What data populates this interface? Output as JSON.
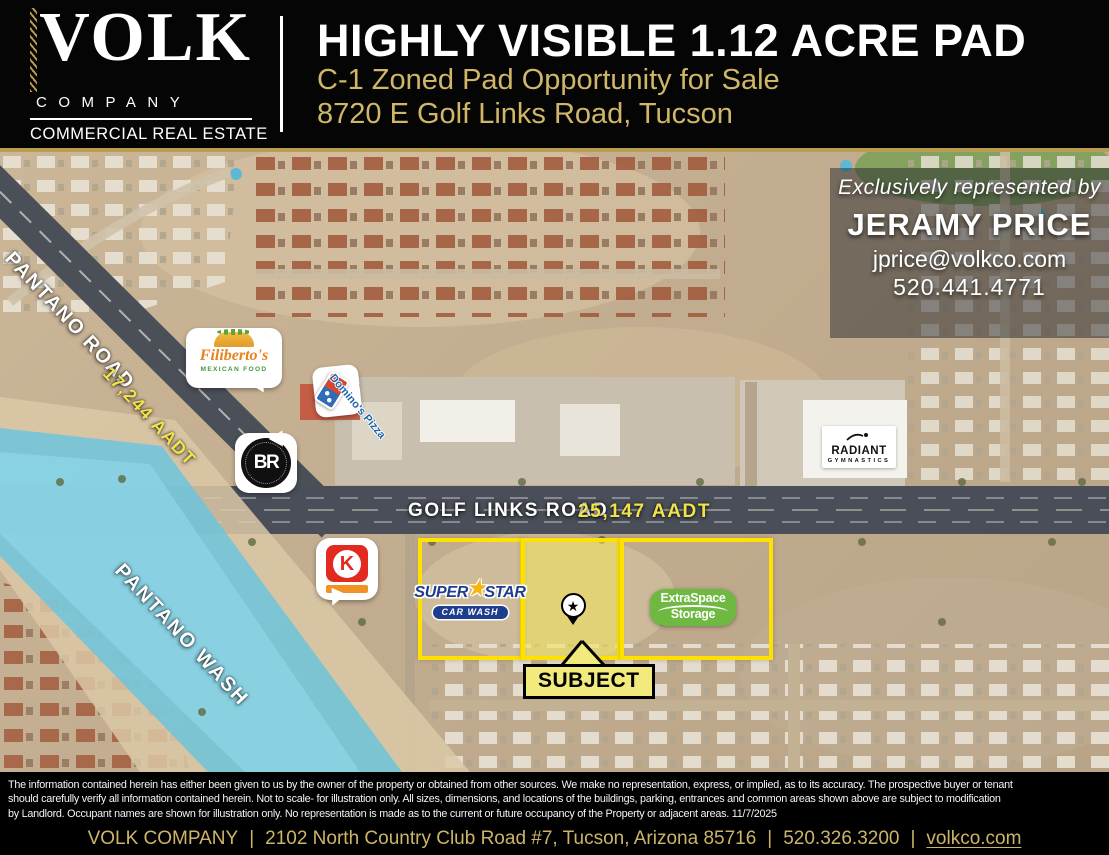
{
  "header": {
    "logo": {
      "wordmark": "VOLK",
      "company": "COMPANY",
      "tagline": "COMMERCIAL REAL ESTATE"
    },
    "title": "HIGHLY VISIBLE 1.12 ACRE PAD",
    "subtitle1": "C-1 Zoned Pad Opportunity for Sale",
    "subtitle2": "8720 E Golf Links Road, Tucson"
  },
  "agent": {
    "intro": "Exclusively represented by",
    "name": "JERAMY PRICE",
    "email": "jprice@volkco.com",
    "phone": "520.441.4771"
  },
  "map": {
    "labels": {
      "pantano_road": "PANTANO ROAD",
      "pantano_aadt": "17,244 AADT",
      "golf_links_road": "GOLF LINKS ROAD",
      "golf_links_aadt": "25,147 AADT",
      "pantano_wash": "PANTANO WASH",
      "subject": "SUBJECT"
    },
    "businesses": {
      "filibertos_name": "Filiberto's",
      "filibertos_tag": "MEXICAN FOOD",
      "dominos": "Domino's Pizza",
      "black_rock_monogram": "BR",
      "circle_k_letter": "K",
      "superstar_word1": "SUPER",
      "superstar_word2": "STAR",
      "superstar_line2": "CAR WASH",
      "extraspace_line1": "ExtraSpace",
      "extraspace_line2": "Storage",
      "radiant_line1": "RADIANT",
      "radiant_line2": "GYMNASTICS"
    },
    "icons": {
      "subject_pin_star": "★",
      "superstar_star": "★"
    }
  },
  "disclaimer": {
    "line1": "The information contained herein has either been given to us by  the owner of the property or obtained from other sources. We make no representation, express, or implied, as to its accuracy. The prospective buyer or tenant",
    "line2": "should carefully verify all information contained herein. Not to scale- for illustration only. All sizes, dimensions, and locations of the buildings, parking, entrances and common areas shown above are subject to modification",
    "line3": "by Landlord. Occupant names are shown for illustration only. No representation is made as to the current or future occupancy of the Property or adjacent areas. 11/7/2025"
  },
  "footer": {
    "company": "VOLK COMPANY",
    "address": "2102 North Country Club Road #7, Tucson, Arizona 85716",
    "phone": "520.326.3200",
    "website": "volkco.com",
    "separator": "|"
  },
  "colors": {
    "gold": "#CDB567",
    "parcel_outline": "#FFE100",
    "aadt_yellow": "#F2E24C",
    "wash_blue": "#66C4E0",
    "subject_fill": "#F3EA7D"
  }
}
